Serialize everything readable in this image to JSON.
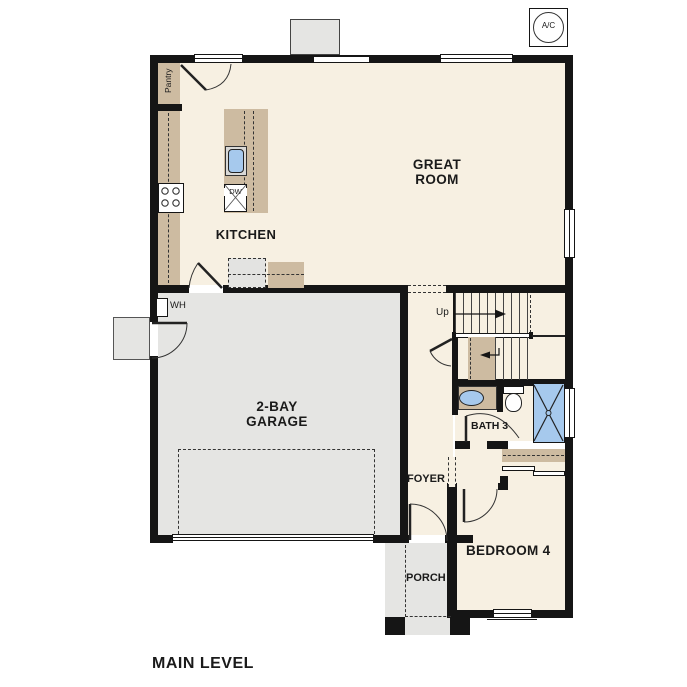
{
  "title": "MAIN LEVEL",
  "rooms": {
    "great_room": "GREAT ROOM",
    "kitchen": "KITCHEN",
    "garage": "2-BAY GARAGE",
    "bath": "BATH 3",
    "foyer": "FOYER",
    "porch": "PORCH",
    "bedroom": "BEDROOM 4"
  },
  "fixtures": {
    "pantry": "Pantry",
    "water_heater": "WH",
    "dishwasher": "DW",
    "ac_unit": "A/C",
    "stairs_up": "Up"
  },
  "colors": {
    "floor": "#F7F0E2",
    "garage_floor": "#E5E5E3",
    "cabinet": "#CDBBA1",
    "water_blue": "#A6C9ED",
    "wall": "#151515"
  }
}
